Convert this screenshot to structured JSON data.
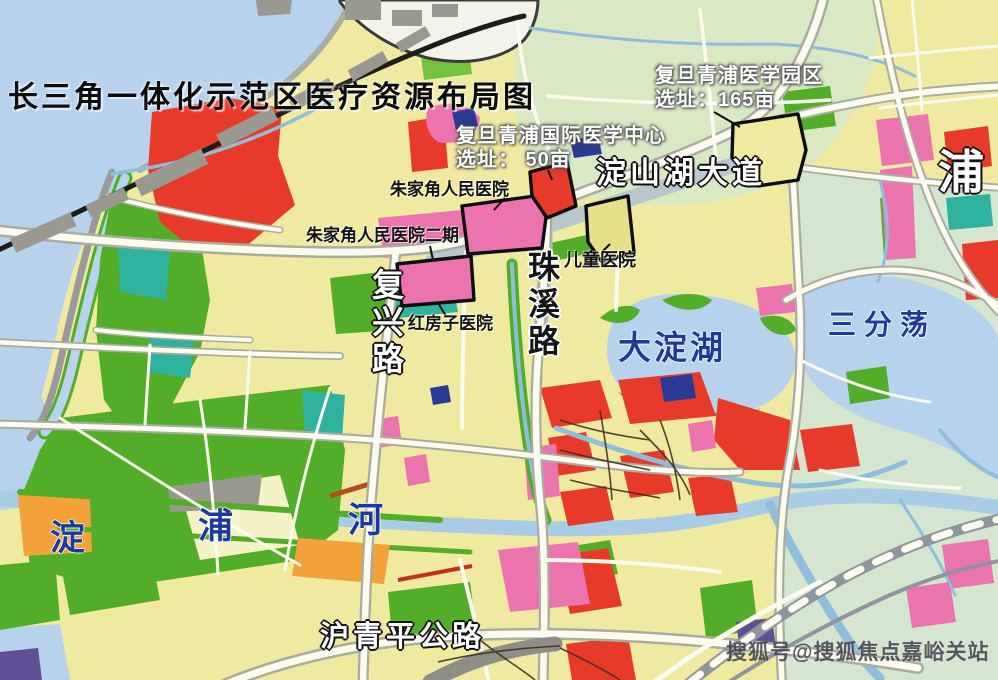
{
  "map": {
    "title": "长三角一体化示范区医疗资源布局图",
    "labels": {
      "fudan_park_line1": "复旦青浦医学园区",
      "fudan_park_line2": "选址：165亩",
      "fudan_center_line1": "复旦青浦国际医学中心",
      "fudan_center_line2": "选址： 50亩",
      "zhujiajiao_hospital": "朱家角人民医院",
      "zhujiajiao_hospital_phase2": "朱家角人民医院二期",
      "children_hospital": "儿童医院",
      "redhouse_hospital": "红房子医院",
      "dianshanhu_avenue": "淀山湖大道",
      "zhuxi_road": "珠溪路",
      "fuxing_road": "复兴路",
      "huqingping_highway": "沪青平公路",
      "dadian_lake": "大淀湖",
      "sanfendang": "三分荡",
      "dianpu_river_char1": "淀",
      "dianpu_river_char2": "浦",
      "dianpu_river_char3": "河",
      "pu_district": "浦",
      "watermark": "搜狐号@搜狐焦点嘉峪关站"
    },
    "colors": {
      "water": "#b7d2ec",
      "land": "#f0e9a0",
      "green": "#52ad28",
      "red": "#e73a28",
      "pink": "#ec74ae",
      "orange": "#f2a238",
      "teal": "#2fb29e",
      "road": "#fcfbf0",
      "outline": "#0d0d0d",
      "rail": "#8e959c"
    }
  }
}
